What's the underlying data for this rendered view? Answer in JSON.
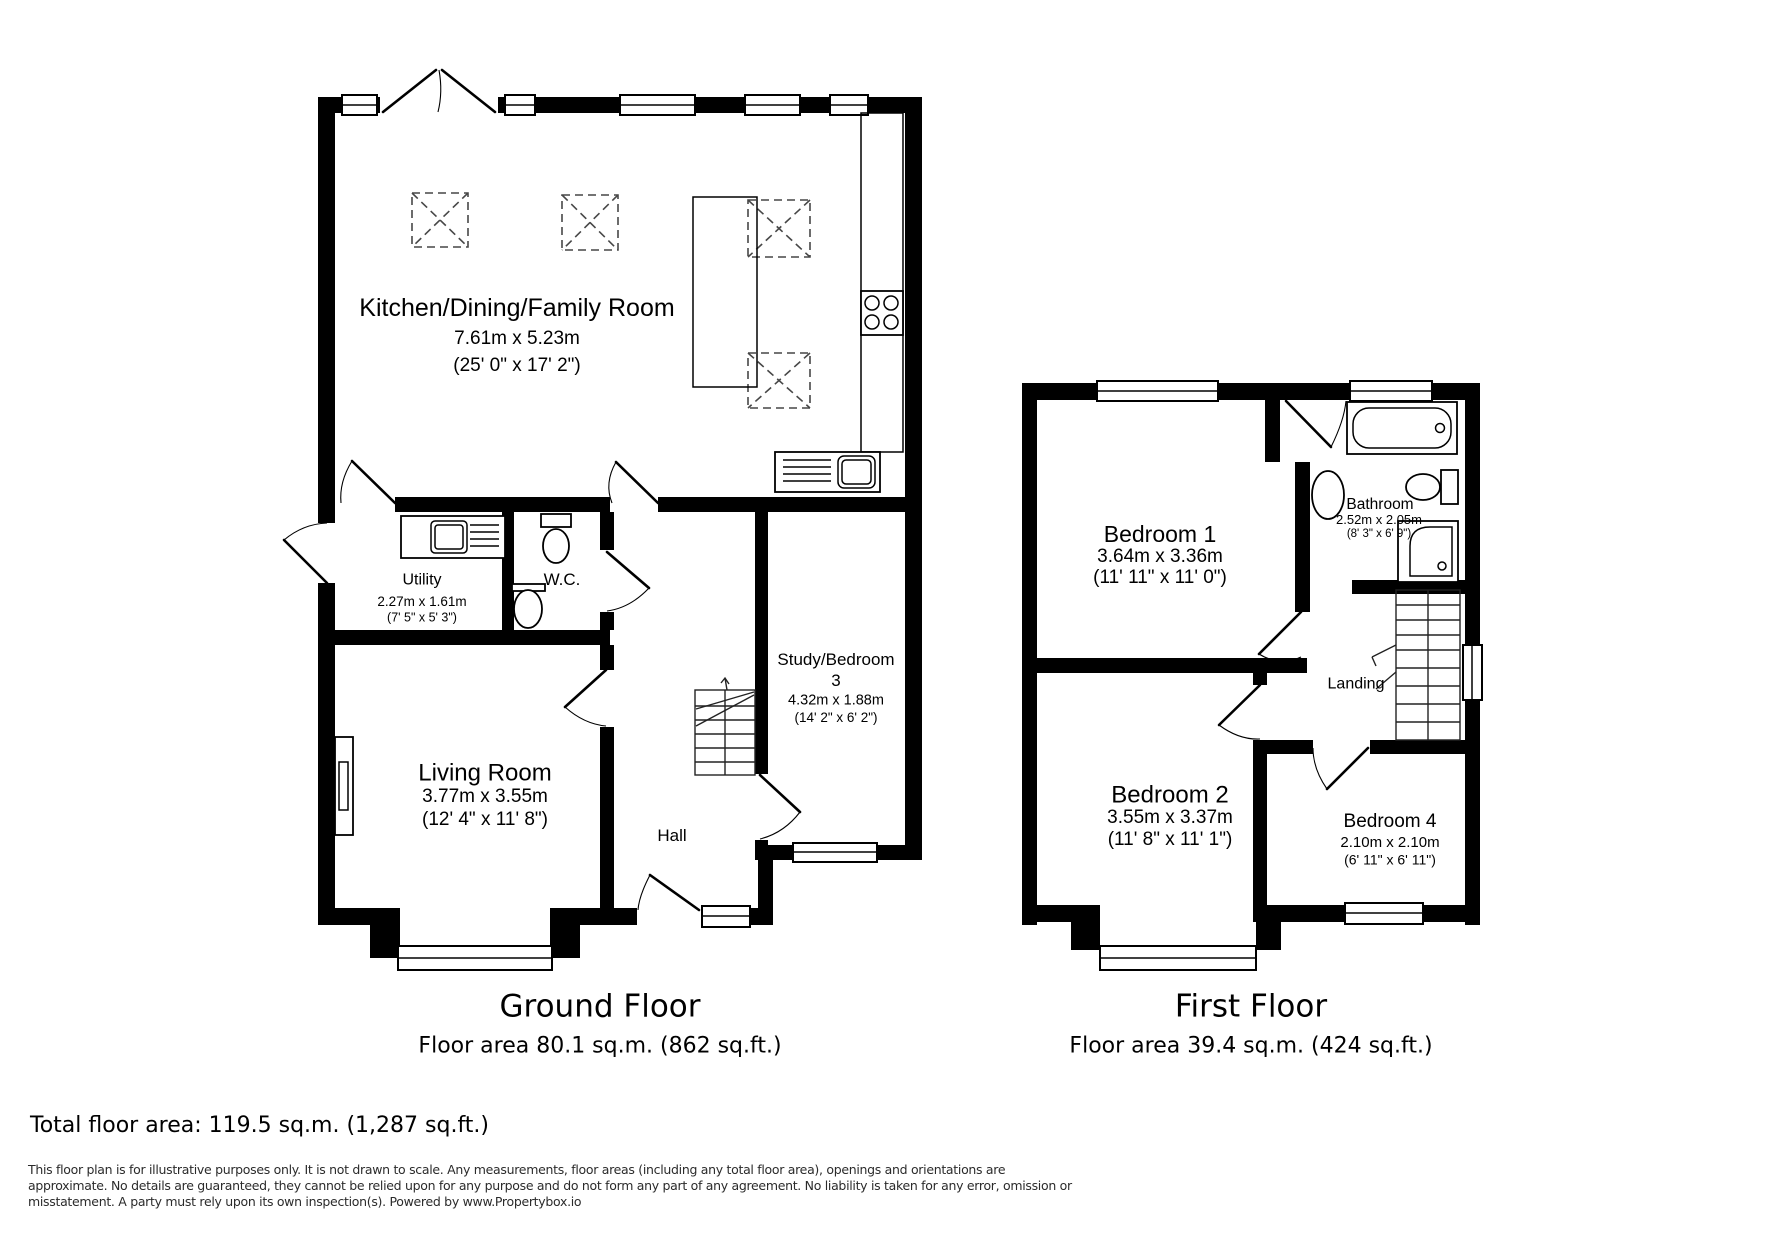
{
  "ground_floor": {
    "title": "Ground Floor",
    "area": "Floor area 80.1 sq.m. (862 sq.ft.)",
    "rooms": {
      "kitchen": {
        "name": "Kitchen/Dining/Family Room",
        "metric": "7.61m x 5.23m",
        "imperial": "(25' 0\" x 17' 2\")"
      },
      "utility": {
        "name": "Utility",
        "metric": "2.27m x 1.61m",
        "imperial": "(7' 5\" x 5' 3\")"
      },
      "wc": {
        "name": "W.C."
      },
      "living_room": {
        "name": "Living Room",
        "metric": "3.77m x 3.55m",
        "imperial": "(12' 4\" x 11' 8\")"
      },
      "study": {
        "name": "Study/Bedroom",
        "number": "3",
        "metric": "4.32m x 1.88m",
        "imperial": "(14' 2\" x 6' 2\")"
      },
      "hall": {
        "name": "Hall"
      }
    }
  },
  "first_floor": {
    "title": "First Floor",
    "area": "Floor area 39.4 sq.m. (424 sq.ft.)",
    "rooms": {
      "bedroom1": {
        "name": "Bedroom 1",
        "metric": "3.64m x 3.36m",
        "imperial": "(11' 11\" x 11' 0\")"
      },
      "bathroom": {
        "name": "Bathroom",
        "metric": "2.52m x 2.05m",
        "imperial": "(8' 3\" x 6' 9\")"
      },
      "landing": {
        "name": "Landing"
      },
      "bedroom2": {
        "name": "Bedroom 2",
        "metric": "3.55m x 3.37m",
        "imperial": "(11' 8\" x 11' 1\")"
      },
      "bedroom4": {
        "name": "Bedroom 4",
        "metric": "2.10m x 2.10m",
        "imperial": "(6' 11\" x 6' 11\")"
      }
    }
  },
  "summary": {
    "total_area": "Total floor area: 119.5 sq.m. (1,287 sq.ft.)"
  },
  "disclaimer": {
    "line1": "This floor plan is for illustrative purposes only. It is not drawn to scale. Any measurements, floor areas (including any total floor area), openings and orientations are",
    "line2": "approximate. No details are guaranteed, they cannot be relied upon for any purpose and do not form any part of any agreement. No liability is taken for any error, omission or",
    "line3": "misstatement. A party must rely upon its own inspection(s). Powered by www.Propertybox.io"
  }
}
